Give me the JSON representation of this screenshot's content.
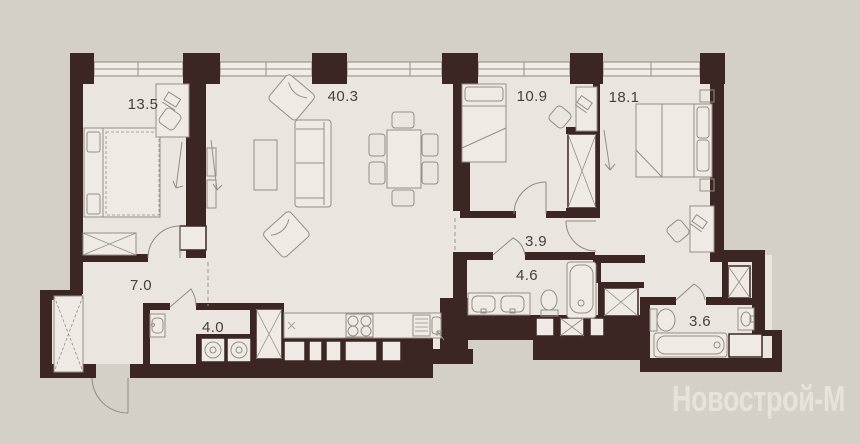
{
  "watermark": "Новострой-М",
  "rooms": [
    {
      "id": "bedroom-1",
      "area": "13.5"
    },
    {
      "id": "living-kitchen",
      "area": "40.3"
    },
    {
      "id": "bedroom-2",
      "area": "10.9"
    },
    {
      "id": "bedroom-3",
      "area": "18.1"
    },
    {
      "id": "hallway",
      "area": "7.0"
    },
    {
      "id": "laundry",
      "area": "4.0"
    },
    {
      "id": "corridor",
      "area": "3.9"
    },
    {
      "id": "bathroom-1",
      "area": "4.6"
    },
    {
      "id": "bathroom-2",
      "area": "3.6"
    }
  ],
  "colors": {
    "background": "#d4d0c8",
    "floor": "#eae6df",
    "wall": "#3b2623",
    "furniture_line": "#948e86",
    "label": "#45403c",
    "watermark": "#e6e3db",
    "window_fill": "#f0ede7"
  }
}
